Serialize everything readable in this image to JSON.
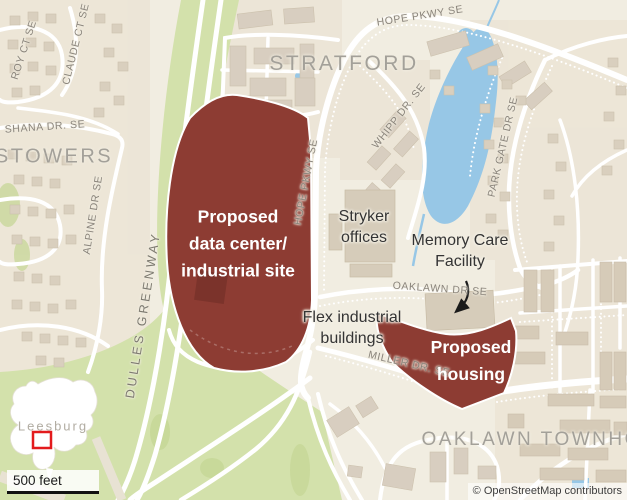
{
  "map": {
    "street_labels": [
      {
        "id": "roy-ct",
        "text": "ROY CT SE"
      },
      {
        "id": "claude-ct",
        "text": "CLAUDE CT SE"
      },
      {
        "id": "shana-dr",
        "text": "SHANA DR. SE"
      },
      {
        "id": "alpine-dr",
        "text": "ALPINE DR SE"
      },
      {
        "id": "dulles-greenway",
        "text": "DULLES GREENWAY"
      },
      {
        "id": "hope-pkwy-top",
        "text": "HOPE PKWY SE"
      },
      {
        "id": "hope-pkwy-mid",
        "text": "HOPE PKWY SE"
      },
      {
        "id": "whipp-dr",
        "text": "WHIPP DR. SE"
      },
      {
        "id": "park-gate-dr",
        "text": "PARK GATE DR SE"
      },
      {
        "id": "oaklawn-dr",
        "text": "OAKLAWN DR SE"
      },
      {
        "id": "miller-dr",
        "text": "MILLER DR. SE"
      }
    ],
    "area_labels": {
      "stowers": "STOWERS",
      "stratford": "STRATFORD",
      "oaklawn_townhomes": "OAKLAWN\nTOWNHOMES"
    },
    "annotations": {
      "data_center_site": "Proposed\ndata center/\nindustrial site",
      "housing_site": "Proposed\nhousing",
      "stryker": "Stryker\noffices",
      "memory_care": "Memory Care\nFacility",
      "flex": "Flex industrial\nbuildings"
    },
    "inset": {
      "city": "Leesburg"
    },
    "scale_bar": "500 feet",
    "attribution": "© OpenStreetMap contributors",
    "colors": {
      "site_red": "#8d3c33",
      "greenway_green": "#d3e1ab",
      "water_blue": "#97c7e6",
      "land": "#f1ede1",
      "building_tan": "#d9cfbe",
      "inset_marker_red": "#e31a1c"
    }
  }
}
